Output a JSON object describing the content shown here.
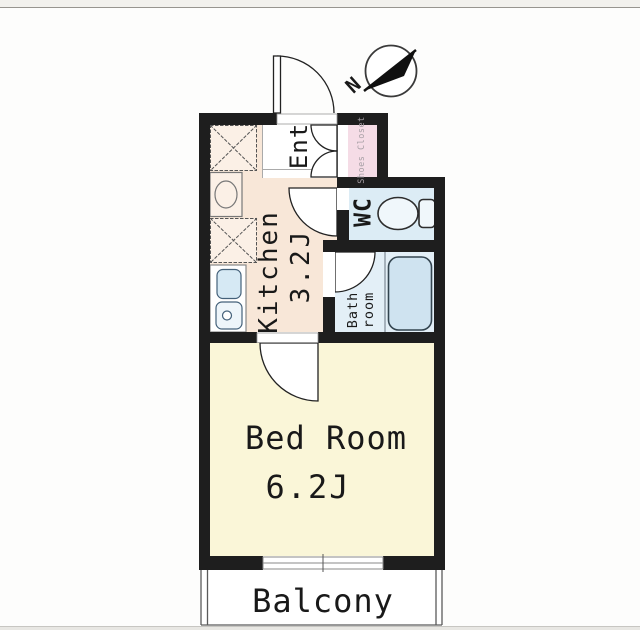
{
  "window": {
    "width": 640,
    "height": 630
  },
  "compass": {
    "north_label": "N"
  },
  "floorplan": {
    "rooms": {
      "kitchen": {
        "label": "Kitchen",
        "size": "3.2J"
      },
      "entrance": {
        "label": "Ent"
      },
      "shoes_closet": {
        "label": "Shoes Closet"
      },
      "wc": {
        "label": "WC"
      },
      "bathroom": {
        "label_line1": "Bath",
        "label_line2": "room"
      },
      "bedroom": {
        "label": "Bed Room",
        "size": "6.2J"
      },
      "balcony": {
        "label": "Balcony"
      }
    },
    "colors": {
      "wall": "#1e1e1e",
      "kitchen_floor": "#f8e7d8",
      "entrance_floor": "#ffffff",
      "shoes_closet": "#f5dce6",
      "wc_floor": "#dcecf5",
      "bath_floor": "#e3eff7",
      "bathtub_fill": "#cfe3f0",
      "sink_fill": "#d6e9f4",
      "bedroom_floor": "#faf6d8",
      "balcony_floor": "#ffffff"
    }
  }
}
